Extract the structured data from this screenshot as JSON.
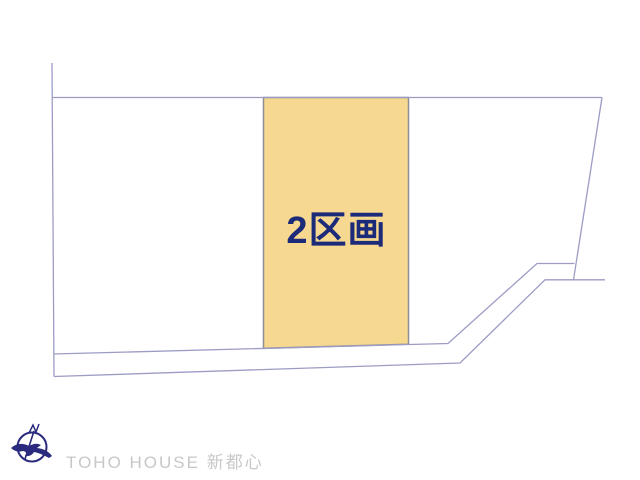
{
  "diagram": {
    "type": "land-plot-layout",
    "parcel": {
      "label": "2区画",
      "highlighted": true
    }
  },
  "logo": {
    "text": "TOHO HOUSE 新都心",
    "icon": "compass-bird-icon"
  },
  "colors": {
    "parcel_fill": "#f7d890",
    "parcel_stroke": "#8e8e96",
    "boundary_line": "#9c9cc4",
    "parcel_label_text": "#1c2a7a",
    "logo_icon": "#2a2a7e",
    "logo_text": "#c8c8c8",
    "background": "#ffffff"
  }
}
